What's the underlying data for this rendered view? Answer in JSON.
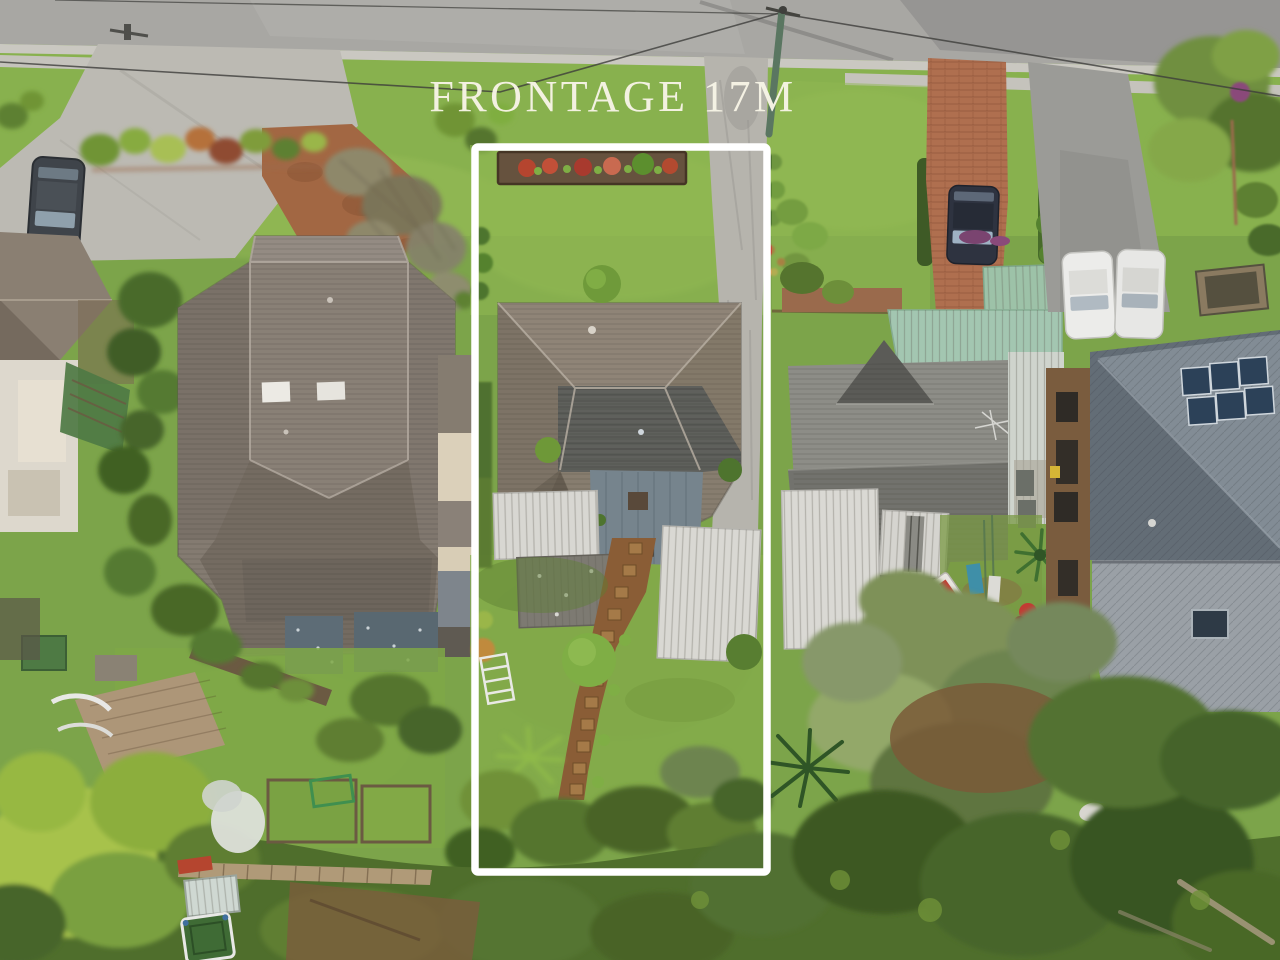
{
  "overlay": {
    "frontage_label": "FRONTAGE 17M",
    "boundary_color": "#ffffff",
    "text_color": "#f7f4e6"
  },
  "scene": {
    "description": "Aerial drone photograph of a suburban street block; the centre lot is outlined with a white boundary rectangle and annotated with its street frontage measurement",
    "palette": {
      "road": "#a8a7a3",
      "gutter": "#cac8c1",
      "concrete_driveway": "#bcbab3",
      "red_dirt_driveway": "#a26743",
      "brick_driveway": "#af6f4f",
      "lawn_bright": "#8db455",
      "lawn_base": "#7ca44a",
      "canopy_dark": "#46652a",
      "canopy_chartreuse": "#a7c24c",
      "roof_left_house": "#857c72",
      "roof_subject_house": "#877d6f",
      "roof_right_house": "#8d8d87",
      "roof_far_right_house": "#76808a",
      "mint_roof": "#a3c6b1",
      "white_outbuilding": "#d9d8d3",
      "solar_panel": "#2c4158",
      "pool_blue": "#3a7fc1"
    }
  }
}
